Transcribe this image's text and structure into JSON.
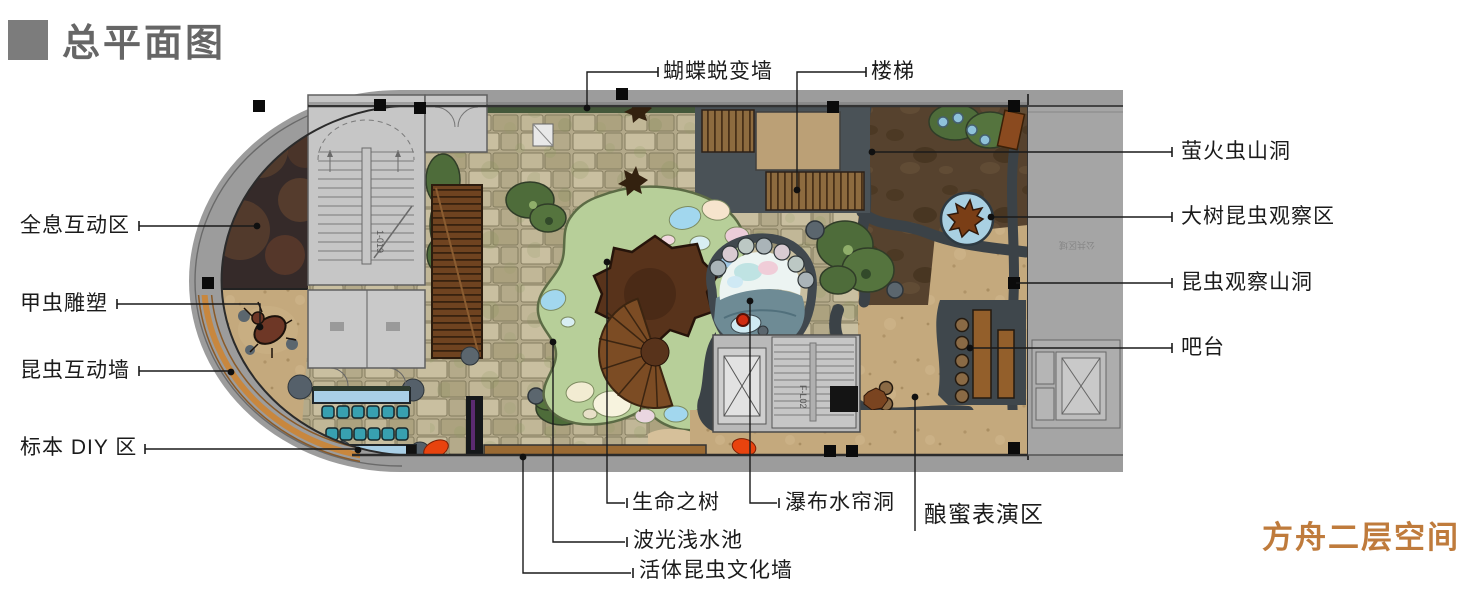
{
  "header": {
    "title": "总平面图"
  },
  "footer": {
    "caption": "方舟二层空间",
    "caption_color": "#bf7b3c"
  },
  "callouts": {
    "butterfly_wall": "蝴蝶蜕变墙",
    "stairs": "楼梯",
    "firefly_cave": "萤火虫山洞",
    "tree_observation": "大树昆虫观察区",
    "insect_observation_cave": "昆虫观察山洞",
    "bar": "吧台",
    "holographic_zone": "全息互动区",
    "beetle_sculpture": "甲虫雕塑",
    "insect_wall": "昆虫互动墙",
    "specimen_diy": "标本 DIY 区",
    "tree_of_life": "生命之树",
    "waterfall_cave": "瀑布水帘洞",
    "honey_show": "酿蜜表演区",
    "shallow_pool": "波光浅水池",
    "live_insect_wall": "活体昆虫文化墙"
  },
  "plan_texts": {
    "stair_code_upper": "1-019",
    "stair_code_lower": "F-L02",
    "rotated_area_text": "公共区域"
  },
  "colors": {
    "title_gray": "#666666",
    "caption_orange": "#bf7b3c",
    "plan_band_gray": "#9c9c9c",
    "stone_paving": "#b9ae8d",
    "sand": "#c4a97d",
    "dark_soil": "#56422e",
    "rock_gray": "#3b4247",
    "amoeba_green": "#b7cf99",
    "bush_green": "#4e6c3a",
    "canopy_brown": "#58331b",
    "deck_brown": "#7c4c24",
    "pool_blue": "#a2d7ee",
    "table_blue": "#a9cfe6",
    "stool_teal": "#38a0b0",
    "accent_red": "#e8430e",
    "wall_orange": "#c8873e"
  }
}
